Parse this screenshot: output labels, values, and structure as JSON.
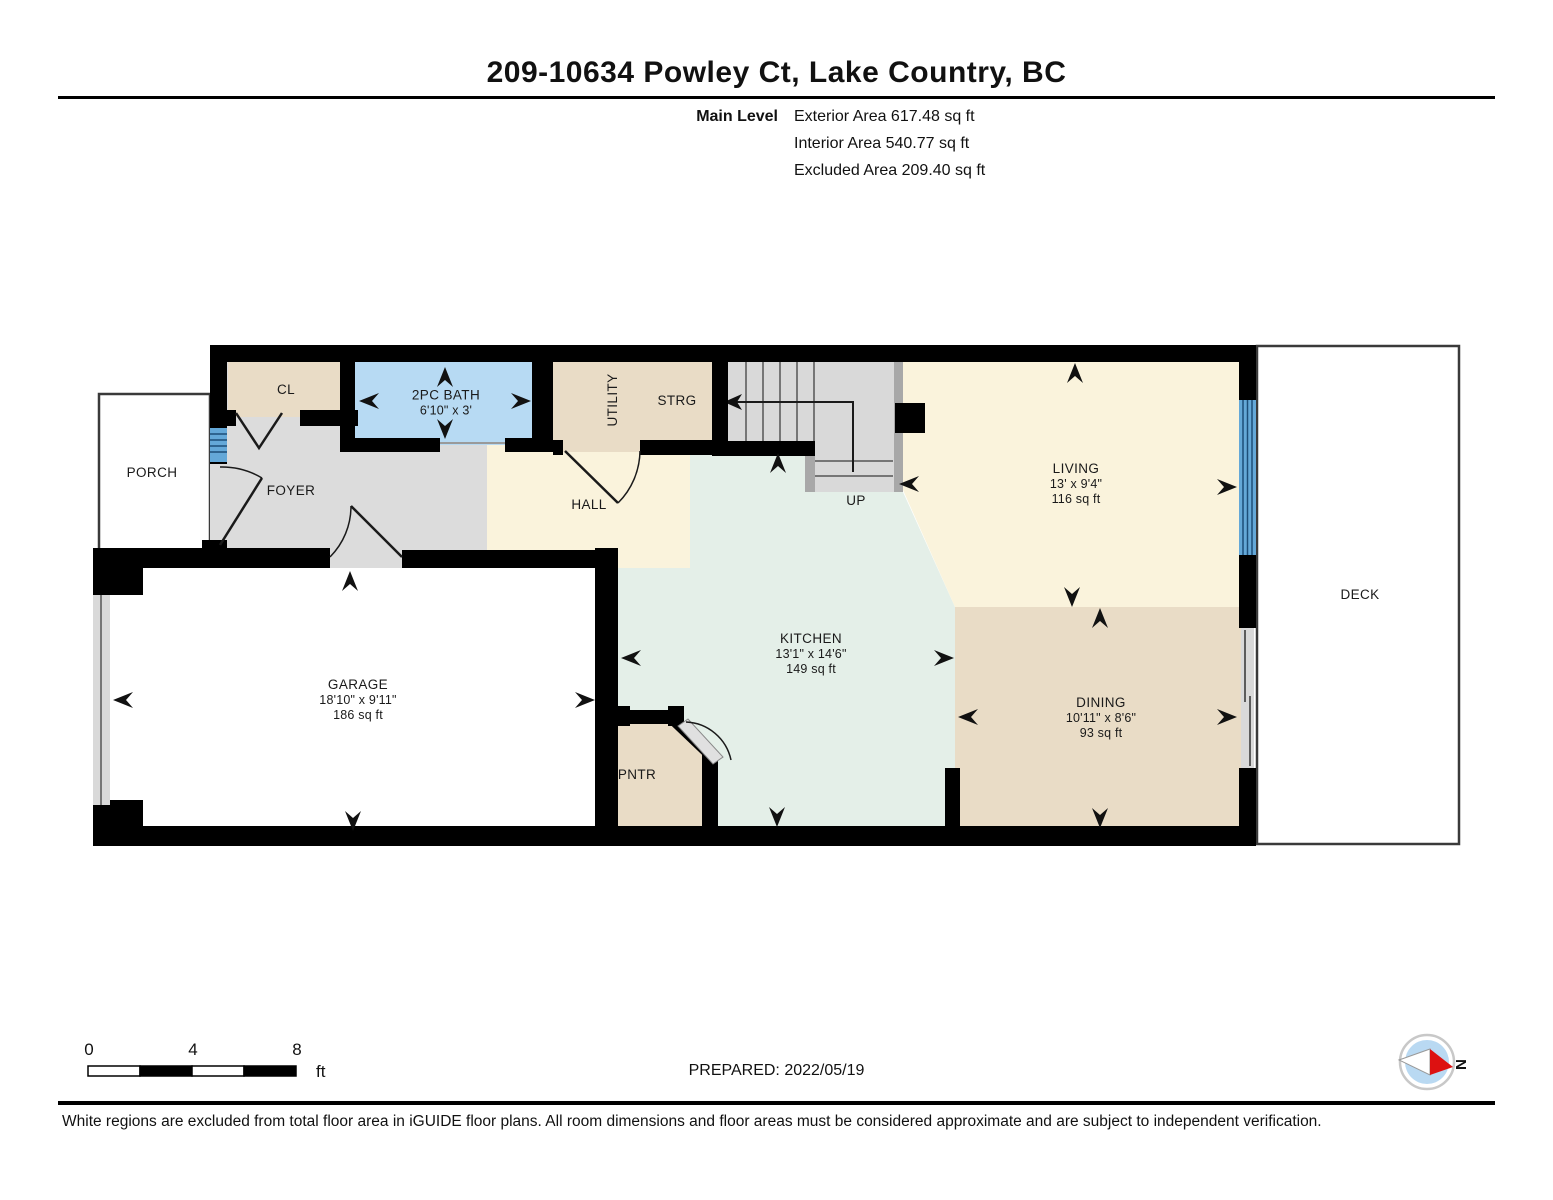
{
  "header": {
    "title": "209-10634 Powley Ct, Lake Country, BC",
    "level_label": "Main Level",
    "stats": {
      "exterior": "Exterior Area 617.48 sq ft",
      "interior": "Interior Area 540.77 sq ft",
      "excluded": "Excluded Area 209.40 sq ft"
    }
  },
  "rooms": {
    "porch": {
      "label": "PORCH"
    },
    "cl": {
      "label": "CL"
    },
    "bath": {
      "label": "2PC BATH",
      "dims": "6'10\" x 3'"
    },
    "utility": {
      "label": "UTILITY"
    },
    "strg": {
      "label": "STRG"
    },
    "foyer": {
      "label": "FOYER"
    },
    "hall": {
      "label": "HALL"
    },
    "stairs": {
      "label": "UP"
    },
    "living": {
      "label": "LIVING",
      "dims": "13' x 9'4\"",
      "area": "116 sq ft"
    },
    "kitchen": {
      "label": "KITCHEN",
      "dims": "13'1\" x 14'6\"",
      "area": "149 sq ft"
    },
    "dining": {
      "label": "DINING",
      "dims": "10'11\" x 8'6\"",
      "area": "93 sq ft"
    },
    "garage": {
      "label": "GARAGE",
      "dims": "18'10\" x 9'11\"",
      "area": "186 sq ft"
    },
    "pantry": {
      "label": "PNTR"
    },
    "deck": {
      "label": "DECK"
    }
  },
  "scale_bar": {
    "tick0": "0",
    "tick4": "4",
    "tick8": "8",
    "unit": "ft"
  },
  "footer": {
    "prepared": "PREPARED: 2022/05/19",
    "disclaimer": "White regions are excluded from total floor area in iGUIDE floor plans. All room dimensions and floor areas must be considered approximate and are subject to independent verification.",
    "compass_label": "N"
  },
  "colors": {
    "wall": "#000000",
    "window_blue": "#64a8d8",
    "window_line": "#1d4e79",
    "bath_blue": "#b7daf3",
    "tan": "#e9dcc6",
    "cream": "#faf3dc",
    "kitchen_teal": "#e4efe8",
    "floor_gray": "#dcdcdc",
    "stair_rail": "#a8a8a8",
    "compass_red": "#dd1111"
  }
}
